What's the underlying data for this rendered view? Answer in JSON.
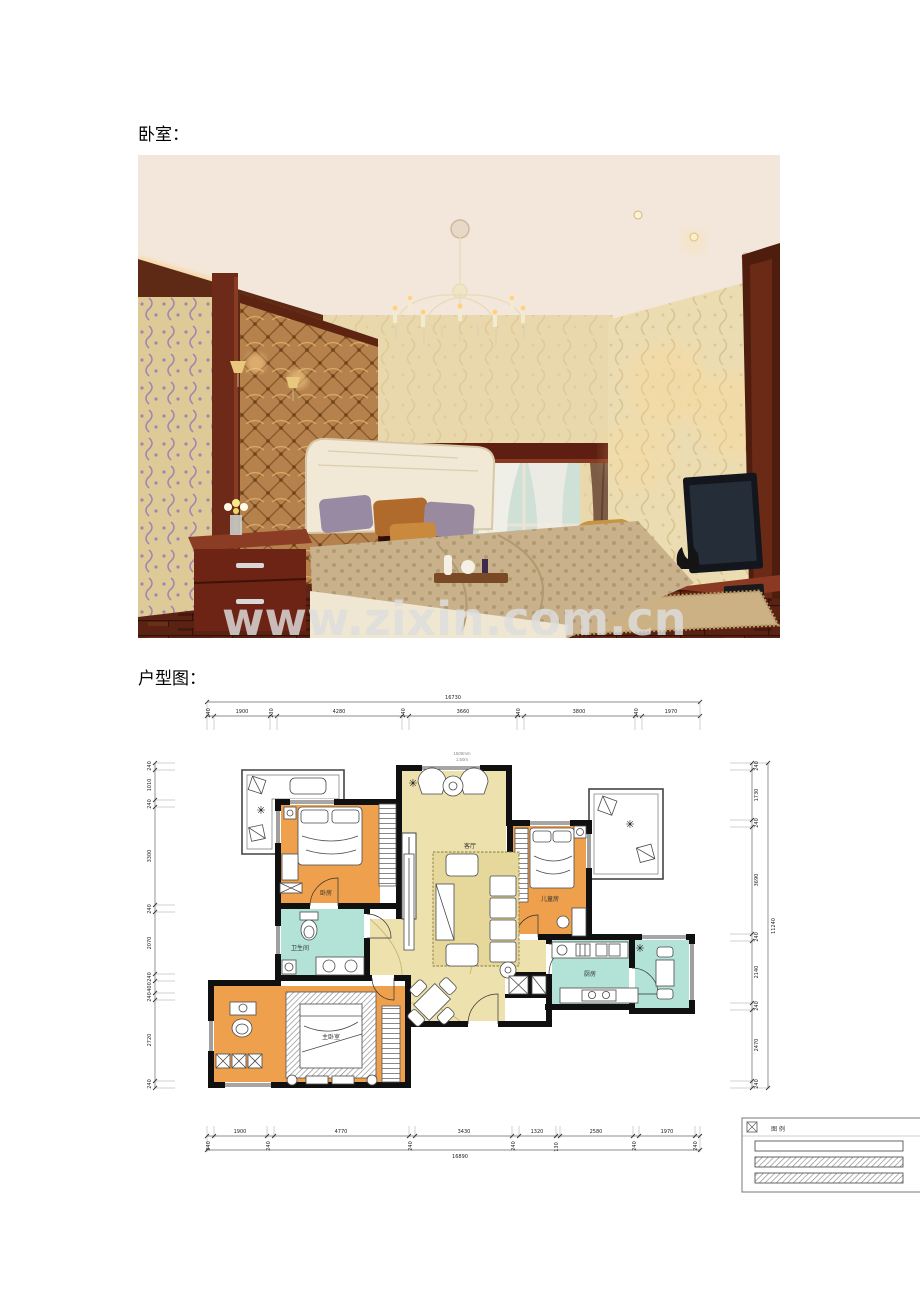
{
  "labels": {
    "bedroom": "卧室：",
    "floor_plan": "户型图："
  },
  "watermark": {
    "text": "www.zixin.com.cn"
  },
  "icons": {
    "plant": "✳"
  },
  "colors": {
    "room_orange": "#EFA04D",
    "room_teal": "#B2E3D6",
    "hall_beige": "#EDE2AE",
    "wall_black": "#101010",
    "wood_dark": "#5E2314",
    "cove_glow": "#FFB24D",
    "watermark_gray": "#DEDEDE"
  },
  "floor_plan": {
    "rooms": {
      "bedroom1": "卧房",
      "bathroom": "卫生间",
      "master_bedroom": "主卧室",
      "living": "客厅",
      "bedroom2": "儿童房",
      "kitchen": "厨房"
    },
    "annotations": {
      "entry_width": "1500mm",
      "entry_height": "1.50m"
    },
    "legend": {
      "title": "图 例"
    },
    "dims_top": {
      "total": "16730",
      "segments": [
        "240",
        "1900",
        "230",
        "4280",
        "240",
        "3660",
        "240",
        "3800",
        "240",
        "1970"
      ]
    },
    "dims_bottom": {
      "total": "16890",
      "row1": [
        "1900",
        "4770",
        "3430",
        "1320",
        "2580",
        "1970"
      ],
      "row2": [
        "240",
        "240",
        "240",
        "240",
        "130",
        "240",
        "240"
      ]
    },
    "dims_left": {
      "segments": [
        "240",
        "1010",
        "240",
        "3300",
        "240",
        "2070",
        "240",
        "400",
        "240",
        "2720",
        "240"
      ]
    },
    "dims_right": {
      "total": "11240",
      "segments": [
        "240",
        "1730",
        "240",
        "3690",
        "240",
        "2140",
        "240",
        "2470",
        "240"
      ]
    }
  }
}
